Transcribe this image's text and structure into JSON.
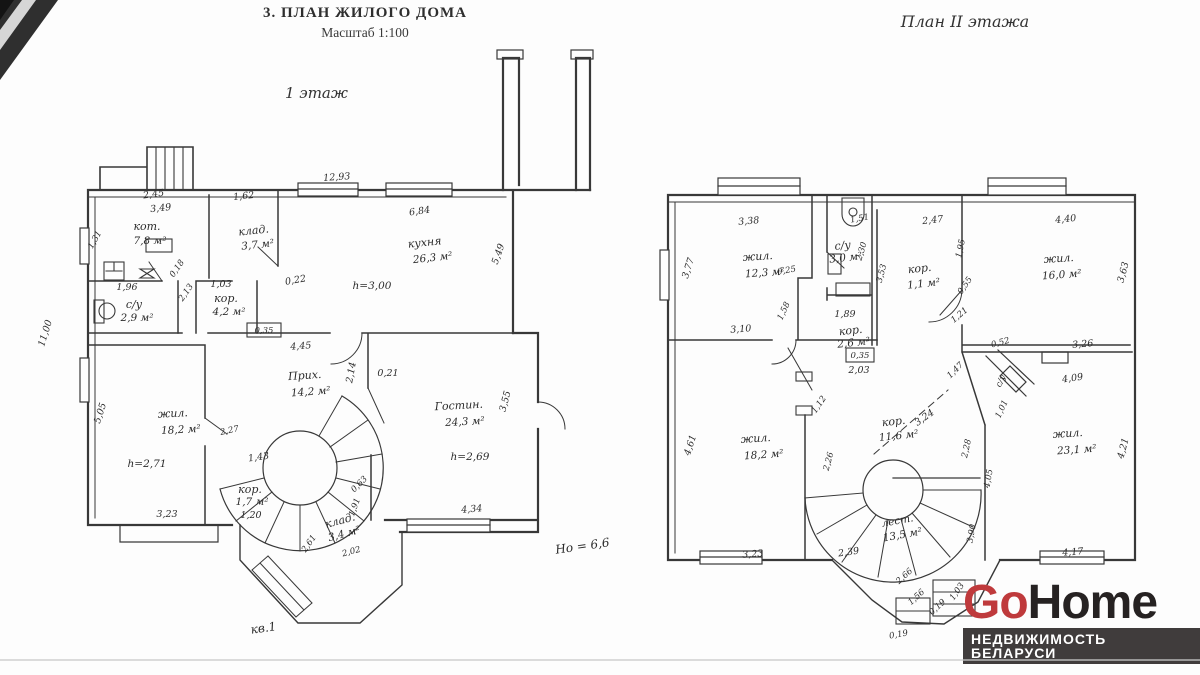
{
  "header": {
    "title": "3. ПЛАН ЖИЛОГО ДОМА",
    "scale": "Масштаб 1:100",
    "floor1_label": "1 этаж",
    "floor2_label": "План II этажа"
  },
  "floor1": {
    "rooms": [
      {
        "name": "кот.",
        "area": "7,8 м²"
      },
      {
        "name": "клад.",
        "area": "3,7 м²"
      },
      {
        "name": "кухня",
        "area": "26,3 м²",
        "height": "h=3,00"
      },
      {
        "name": "с/у",
        "area": "2,9 м²"
      },
      {
        "name": "кор.",
        "area": "4,2 м²"
      },
      {
        "name": "Прих.",
        "area": "14,2 м²"
      },
      {
        "name": "жил.",
        "area": "18,2 м²",
        "height": "h=2,71"
      },
      {
        "name": "Гостин.",
        "area": "24,3 м²",
        "height": "h=2,69"
      },
      {
        "name": "кор.",
        "area": "1,7 м²"
      },
      {
        "name": "клад.",
        "area": "3,4 м²"
      }
    ],
    "dims": [
      "2,45",
      "3,49",
      "1,62",
      "12,93",
      "6,84",
      "0,22",
      "5,49",
      "1,96",
      "1,03",
      "0,18",
      "2,13",
      "0,35",
      "4,45",
      "11,00",
      "1,31",
      "0,21",
      "2,14",
      "5,05",
      "2,27",
      "1,43",
      "1,20",
      "3,23",
      "4,34",
      "3,55",
      "1,91",
      "2,61",
      "0,63",
      "2,02"
    ],
    "notes": {
      "building_height": "Hо = 6,6",
      "apartment": "кв.1"
    }
  },
  "floor2": {
    "rooms": [
      {
        "name": "жил.",
        "area": "12,3 м²"
      },
      {
        "name": "с/у",
        "area": "3,0 м²"
      },
      {
        "name": "кор.",
        "area": "1,1 м²"
      },
      {
        "name": "жил.",
        "area": "16,0 м²"
      },
      {
        "name": "кор.",
        "area": "2,6 м²"
      },
      {
        "name": "жил.",
        "area": "18,2 м²"
      },
      {
        "name": "кор.",
        "area": "11,6 м²"
      },
      {
        "name": "жил.",
        "area": "23,1 м²"
      },
      {
        "name": "лест.",
        "area": "13,5 м²"
      },
      {
        "name": "с/у",
        "area": ""
      }
    ],
    "dims": [
      "3,38",
      "1,51",
      "2,47",
      "4,40",
      "3,77",
      "0,25",
      "1,58",
      "3,10",
      "2,30",
      "1,89",
      "0,35",
      "2,03",
      "3,53",
      "1,95",
      "0,55",
      "1,21",
      "3,63",
      "3,26",
      "4,09",
      "0,52",
      "1,47",
      "1,01",
      "4,61",
      "3,23",
      "1,12",
      "2,26",
      "3,24",
      "2,28",
      "4,05",
      "3,90",
      "2,39",
      "4,17",
      "4,21",
      "2,66",
      "1,56",
      "0,19",
      "1,03"
    ]
  },
  "logo": {
    "go": "Go",
    "home": "Home",
    "tagline": "НЕДВИЖИМОСТЬ БЕЛАРУСИ",
    "colors": {
      "go": "#bf3a3c",
      "home": "#262222",
      "bar_bg": "#403c3c",
      "bar_text": "#ffffff"
    }
  },
  "colors": {
    "ink": "#2f2f2f",
    "paper": "#fdfdfd"
  }
}
